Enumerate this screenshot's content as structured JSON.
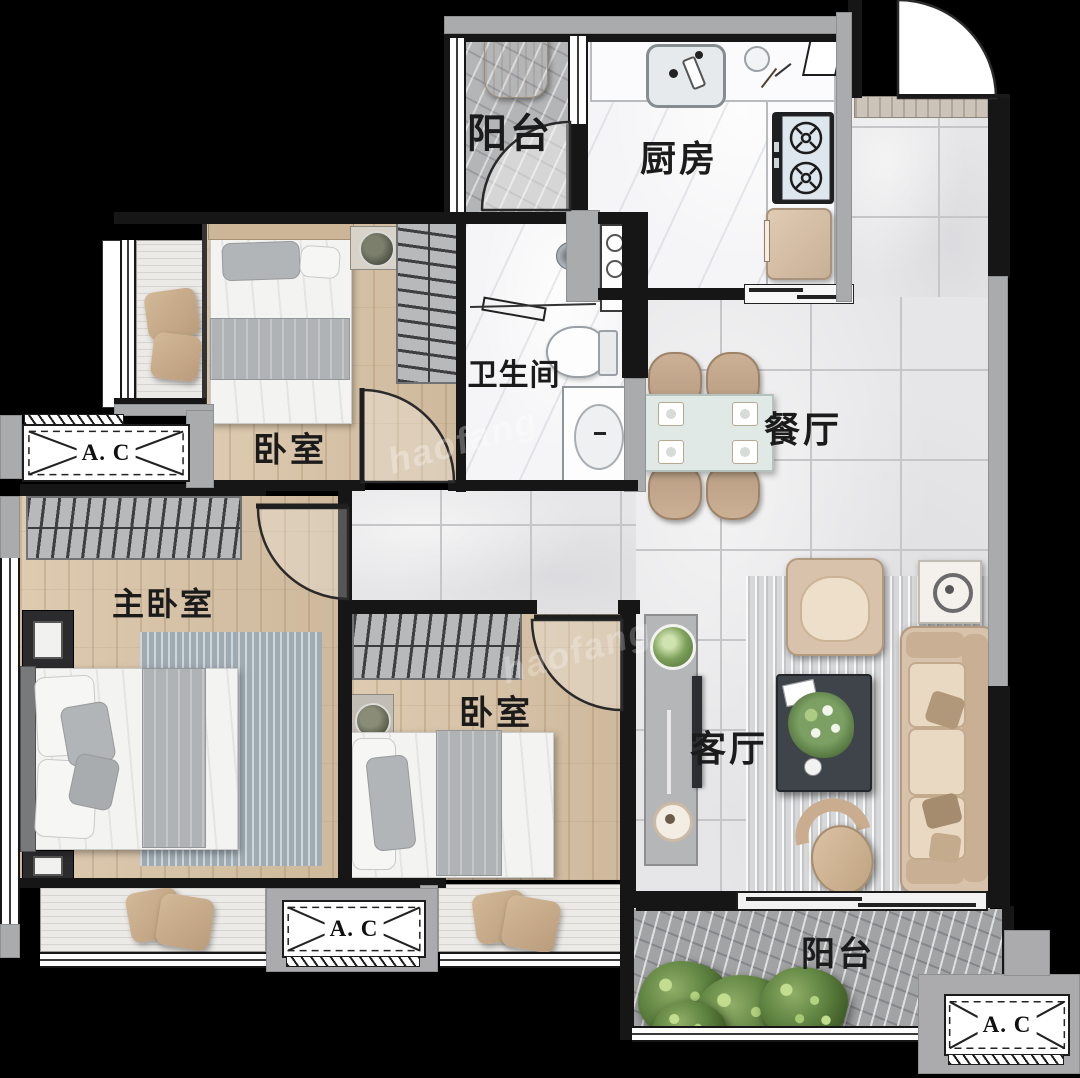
{
  "canvas": {
    "width": 1080,
    "height": 1078,
    "background": "#000000"
  },
  "labels": {
    "balcony_top": "阳台",
    "kitchen": "厨房",
    "bedroom_top": "卧室",
    "bathroom": "卫生间",
    "dining": "餐厅",
    "master_bedroom": "主卧室",
    "bedroom_bottom": "卧室",
    "living_room": "客厅",
    "balcony_bottom": "阳台",
    "ac_unit": "A. C",
    "watermark": "haofang"
  },
  "colors": {
    "wall": "#161616",
    "secondary_wall": "#a9abad",
    "wood_floor": "#d9c3a5",
    "tile_floor": "#e6e6e8",
    "marble_floor": "#f5f5f7",
    "balcony_stone": "#b4b5b7",
    "furniture_beige": "#d6bfa8",
    "dining_table": "#dfe8e4",
    "label_text": "#1b1b1b"
  }
}
